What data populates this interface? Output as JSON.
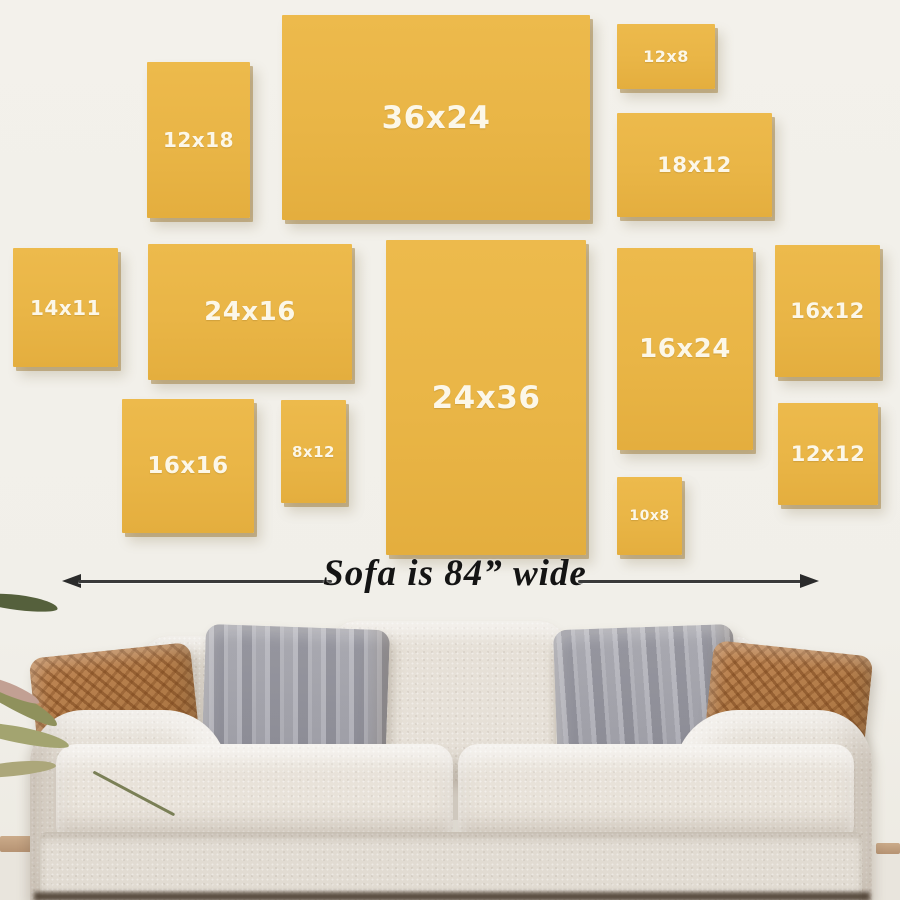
{
  "graphic": {
    "background_color": "#f2f0ea",
    "canvas_fill_color": "#e9b546",
    "canvas_label_color": "#fcf7e8",
    "canvases": [
      {
        "label": "12x18",
        "x": 147,
        "y": 62,
        "w": 103,
        "h": 156,
        "fs": 20
      },
      {
        "label": "36x24",
        "x": 282,
        "y": 15,
        "w": 308,
        "h": 205,
        "fs": 31
      },
      {
        "label": "12x8",
        "x": 617,
        "y": 24,
        "w": 98,
        "h": 65,
        "fs": 16
      },
      {
        "label": "18x12",
        "x": 617,
        "y": 113,
        "w": 155,
        "h": 104,
        "fs": 21
      },
      {
        "label": "14x11",
        "x": 13,
        "y": 248,
        "w": 105,
        "h": 119,
        "fs": 20
      },
      {
        "label": "24x16",
        "x": 148,
        "y": 244,
        "w": 204,
        "h": 136,
        "fs": 26
      },
      {
        "label": "16x16",
        "x": 122,
        "y": 399,
        "w": 132,
        "h": 134,
        "fs": 23
      },
      {
        "label": "8x12",
        "x": 281,
        "y": 400,
        "w": 65,
        "h": 103,
        "fs": 15
      },
      {
        "label": "24x36",
        "x": 386,
        "y": 240,
        "w": 200,
        "h": 315,
        "fs": 31
      },
      {
        "label": "16x24",
        "x": 617,
        "y": 248,
        "w": 136,
        "h": 202,
        "fs": 26
      },
      {
        "label": "10x8",
        "x": 617,
        "y": 477,
        "w": 65,
        "h": 78,
        "fs": 14
      },
      {
        "label": "16x12",
        "x": 775,
        "y": 245,
        "w": 105,
        "h": 132,
        "fs": 21
      },
      {
        "label": "12x12",
        "x": 778,
        "y": 403,
        "w": 100,
        "h": 102,
        "fs": 21
      }
    ],
    "dimension_note": {
      "text": "Sofa is 84” wide",
      "arrow_color": "#2b2b2b"
    },
    "sofa": {
      "fabric_color": "#e3ddd4",
      "pillow_brown_color": "#b07a47",
      "pillow_gray_color": "#c6c6cb"
    }
  }
}
